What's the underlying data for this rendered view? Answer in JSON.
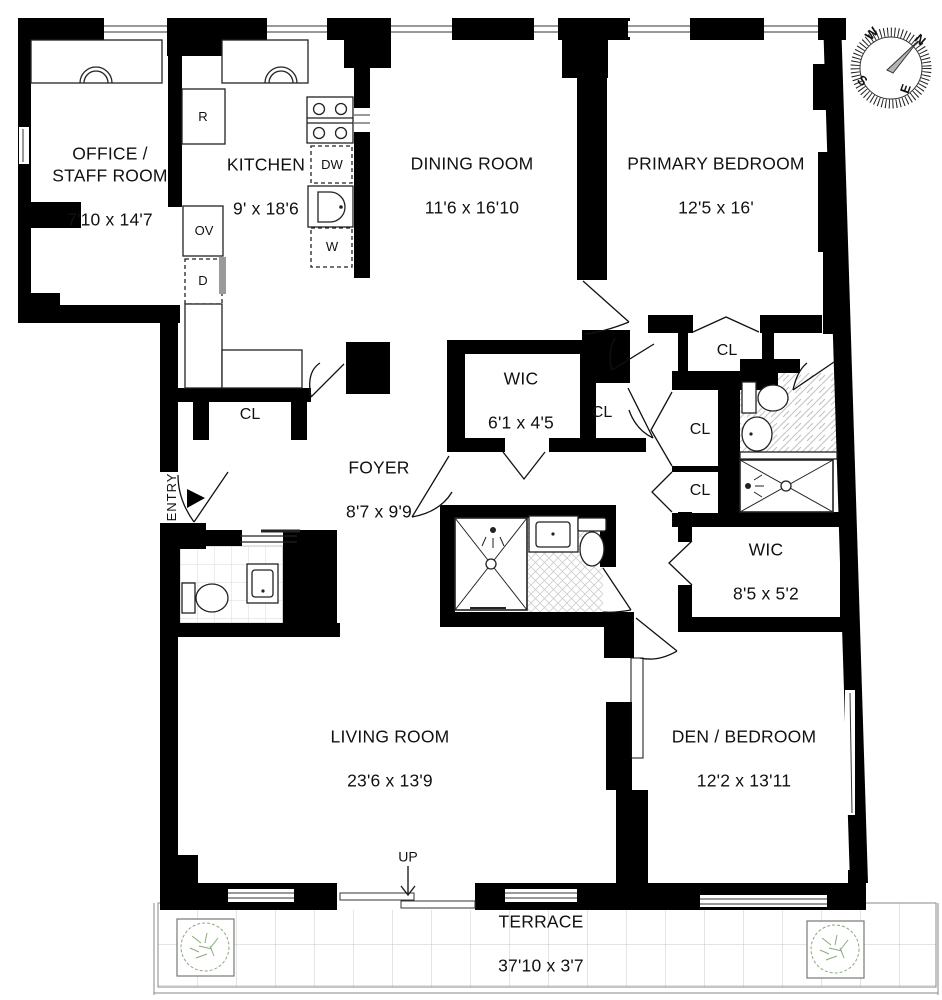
{
  "rooms": [
    {
      "name": "OFFICE /\nSTAFF ROOM",
      "dims": "7'10 x 14'7"
    },
    {
      "name": "KITCHEN",
      "dims": "9' x 18'6"
    },
    {
      "name": "DINING ROOM",
      "dims": "11'6 x 16'10"
    },
    {
      "name": "PRIMARY BEDROOM",
      "dims": "12'5 x 16'"
    },
    {
      "name": "WIC",
      "dims": "6'1 x 4'5"
    },
    {
      "name": "FOYER",
      "dims": "8'7 x 9'9"
    },
    {
      "name": "WIC",
      "dims": "8'5 x 5'2"
    },
    {
      "name": "LIVING ROOM",
      "dims": "23'6 x 13'9"
    },
    {
      "name": "DEN / BEDROOM",
      "dims": "12'2 x 13'11"
    },
    {
      "name": "TERRACE",
      "dims": "37'10 x 3'7"
    }
  ],
  "closets": {
    "labels": [
      "CL",
      "CL",
      "CL",
      "CL",
      "CL"
    ]
  },
  "appliances": {
    "refrigerator": "R",
    "oven": "OV",
    "dryer": "D",
    "dishwasher": "DW",
    "washer": "W"
  },
  "markers": {
    "entry": "ENTRY",
    "up": "UP"
  },
  "compass": {
    "north": "N",
    "east": "E",
    "south": "S",
    "west": "W"
  },
  "colors": {
    "wall": "#000000",
    "plant": "#8aa97c",
    "tile_line": "#c9c9c9"
  }
}
